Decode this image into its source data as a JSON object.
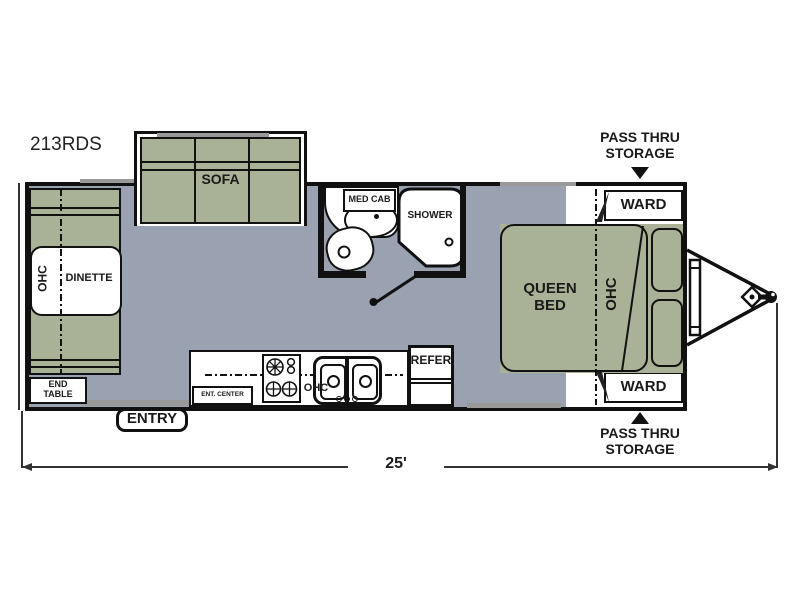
{
  "model_label": "213RDS",
  "dimension": {
    "length": "25'"
  },
  "callouts": {
    "entry": "ENTRY",
    "pass_thru_top": {
      "line1": "PASS THRU",
      "line2": "STORAGE"
    },
    "pass_thru_bottom": {
      "line1": "PASS THRU",
      "line2": "STORAGE"
    }
  },
  "rooms": {
    "sofa": {
      "label": "SOFA"
    },
    "dinette": {
      "label": "DINETTE",
      "ohc": "OHC",
      "end_table": {
        "line1": "END",
        "line2": "TABLE"
      }
    },
    "kitchen": {
      "ent_center": "ENT. CENTER",
      "ohc": "OHC",
      "refer": "REFER"
    },
    "bath": {
      "med_cab": "MED CAB",
      "shower": "SHOWER"
    },
    "bedroom": {
      "bed": {
        "line1": "QUEEN",
        "line2": "BED"
      },
      "ohc": "OHC",
      "ward_top": "WARD",
      "ward_bottom": "WARD"
    }
  },
  "colors": {
    "floor": "#9aa1b1",
    "furniture_green": "#a9b197",
    "wall": "#111111",
    "detail_gray": "#999999",
    "background": "#ffffff",
    "text": "#1a1a1a"
  }
}
